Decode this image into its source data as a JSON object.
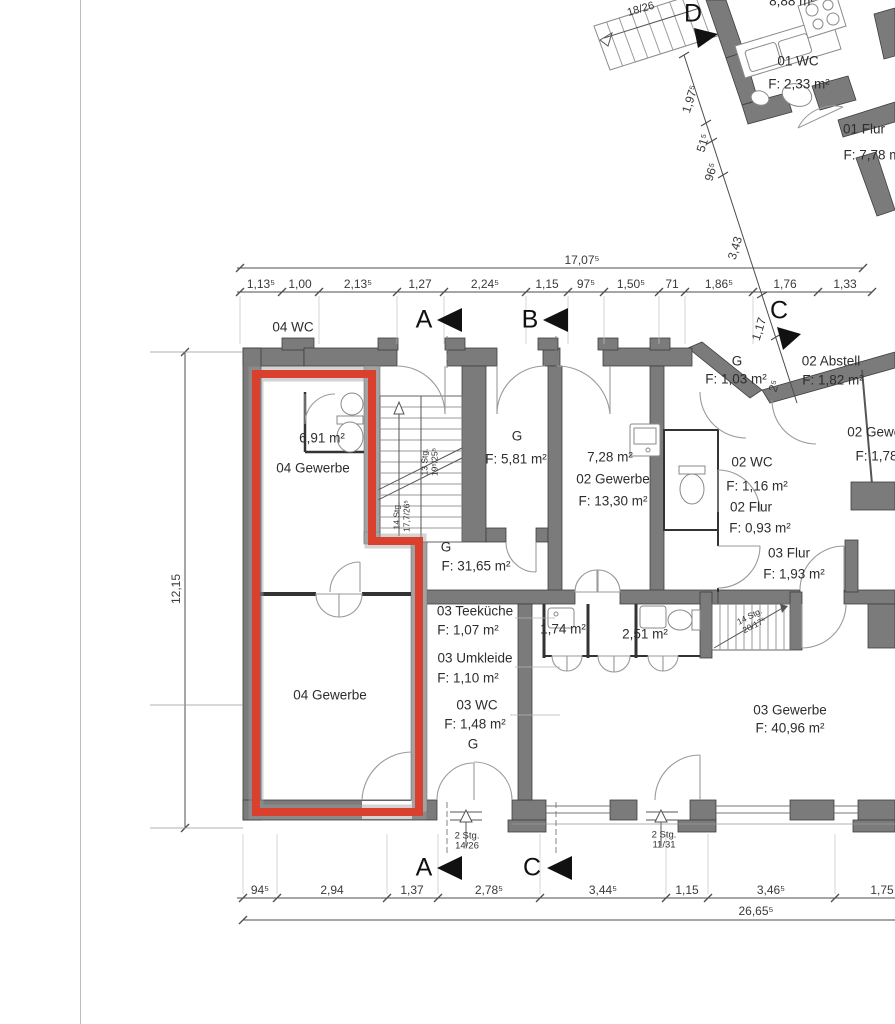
{
  "colors": {
    "highlight_red": "#d9412e",
    "wall_gray": "#7b7b7b",
    "wall_light": "#a7a7a7",
    "line_dark": "#333333",
    "dim_line": "#4d4d4d"
  },
  "markers": {
    "a": "A",
    "b": "B",
    "c": "C",
    "d": "D"
  },
  "rooms": {
    "top_partial": "8,88 m²",
    "wc01": "01 WC",
    "wc01_area": "F: 2,33 m²",
    "flur01": "01 Flur",
    "flur01_area": "F: 7,78 m",
    "wc04": "04 WC",
    "gew04_upper": "04 Gewerbe",
    "gew04_upper_area": "6,91 m²",
    "gew04_lower": "04 Gewerbe",
    "g_stair": "G",
    "g_stair_area": "F: 5,81 m²",
    "gew02_small_area": "7,28 m²",
    "gew02": "02 Gewerbe",
    "gew02_area": "F: 13,30 m²",
    "wc02": "02 WC",
    "wc02_area": "F: 1,16 m²",
    "flur02": "02 Flur",
    "flur02_area": "F: 0,93 m²",
    "g_mid": "G",
    "g_mid_area": "F: 1,03 m²",
    "abstell02": "02 Abstell",
    "abstell02_area": "F: 1,82 m²",
    "gew02_right": "02 Gewerbe",
    "gew02_right_area": "F: 1,78 m",
    "g_hall": "G",
    "g_hall_area": "F: 31,65 m²",
    "flur03": "03 Flur",
    "flur03_area": "F: 1,93 m²",
    "teekueche03": "03 Teeküche",
    "teekueche03_area": "F: 1,07 m²",
    "umkleide03": "03 Umkleide",
    "umkleide03_area": "F: 1,10 m²",
    "wc03": "03 WC",
    "wc03_area": "F: 1,48 m²",
    "g_hall2": "G",
    "small_area_1": "1,74 m²",
    "small_area_2": "2,51 m²",
    "gew03": "03 Gewerbe",
    "gew03_area": "F: 40,96 m²"
  },
  "stairs": {
    "wing": "18/26",
    "main_up_1": "13 Stg.",
    "main_up_2": "19⁵/25⁵",
    "main_down_1": "14 Stg.",
    "main_down_2": "17,7/26⁵",
    "right_1": "14 Stg.",
    "right_2": "20/17⁵",
    "entry1_1": "2 Stg.",
    "entry1_2": "14/26",
    "entry2_1": "2 Stg.",
    "entry2_2": "11/31"
  },
  "dims": {
    "top_total": "17,07⁵",
    "top_segments": [
      "1,13⁵",
      "1,00",
      "2,13⁵",
      "1,27",
      "2,24⁵",
      "1,15",
      "97⁵",
      "1,50⁵",
      "71",
      "1,86⁵",
      "1,76",
      "1,33"
    ],
    "bottom_segments": [
      "94⁵",
      "2,94",
      "1,37",
      "2,78⁵",
      "3,44⁵",
      "1,15",
      "3,46⁵",
      "1,75"
    ],
    "bottom_total": "26,65⁵",
    "left_height": "12,15",
    "diagonal": [
      "1,97⁵",
      "51⁵",
      "96⁵",
      "3,43",
      "1,17",
      "2⁵"
    ]
  }
}
